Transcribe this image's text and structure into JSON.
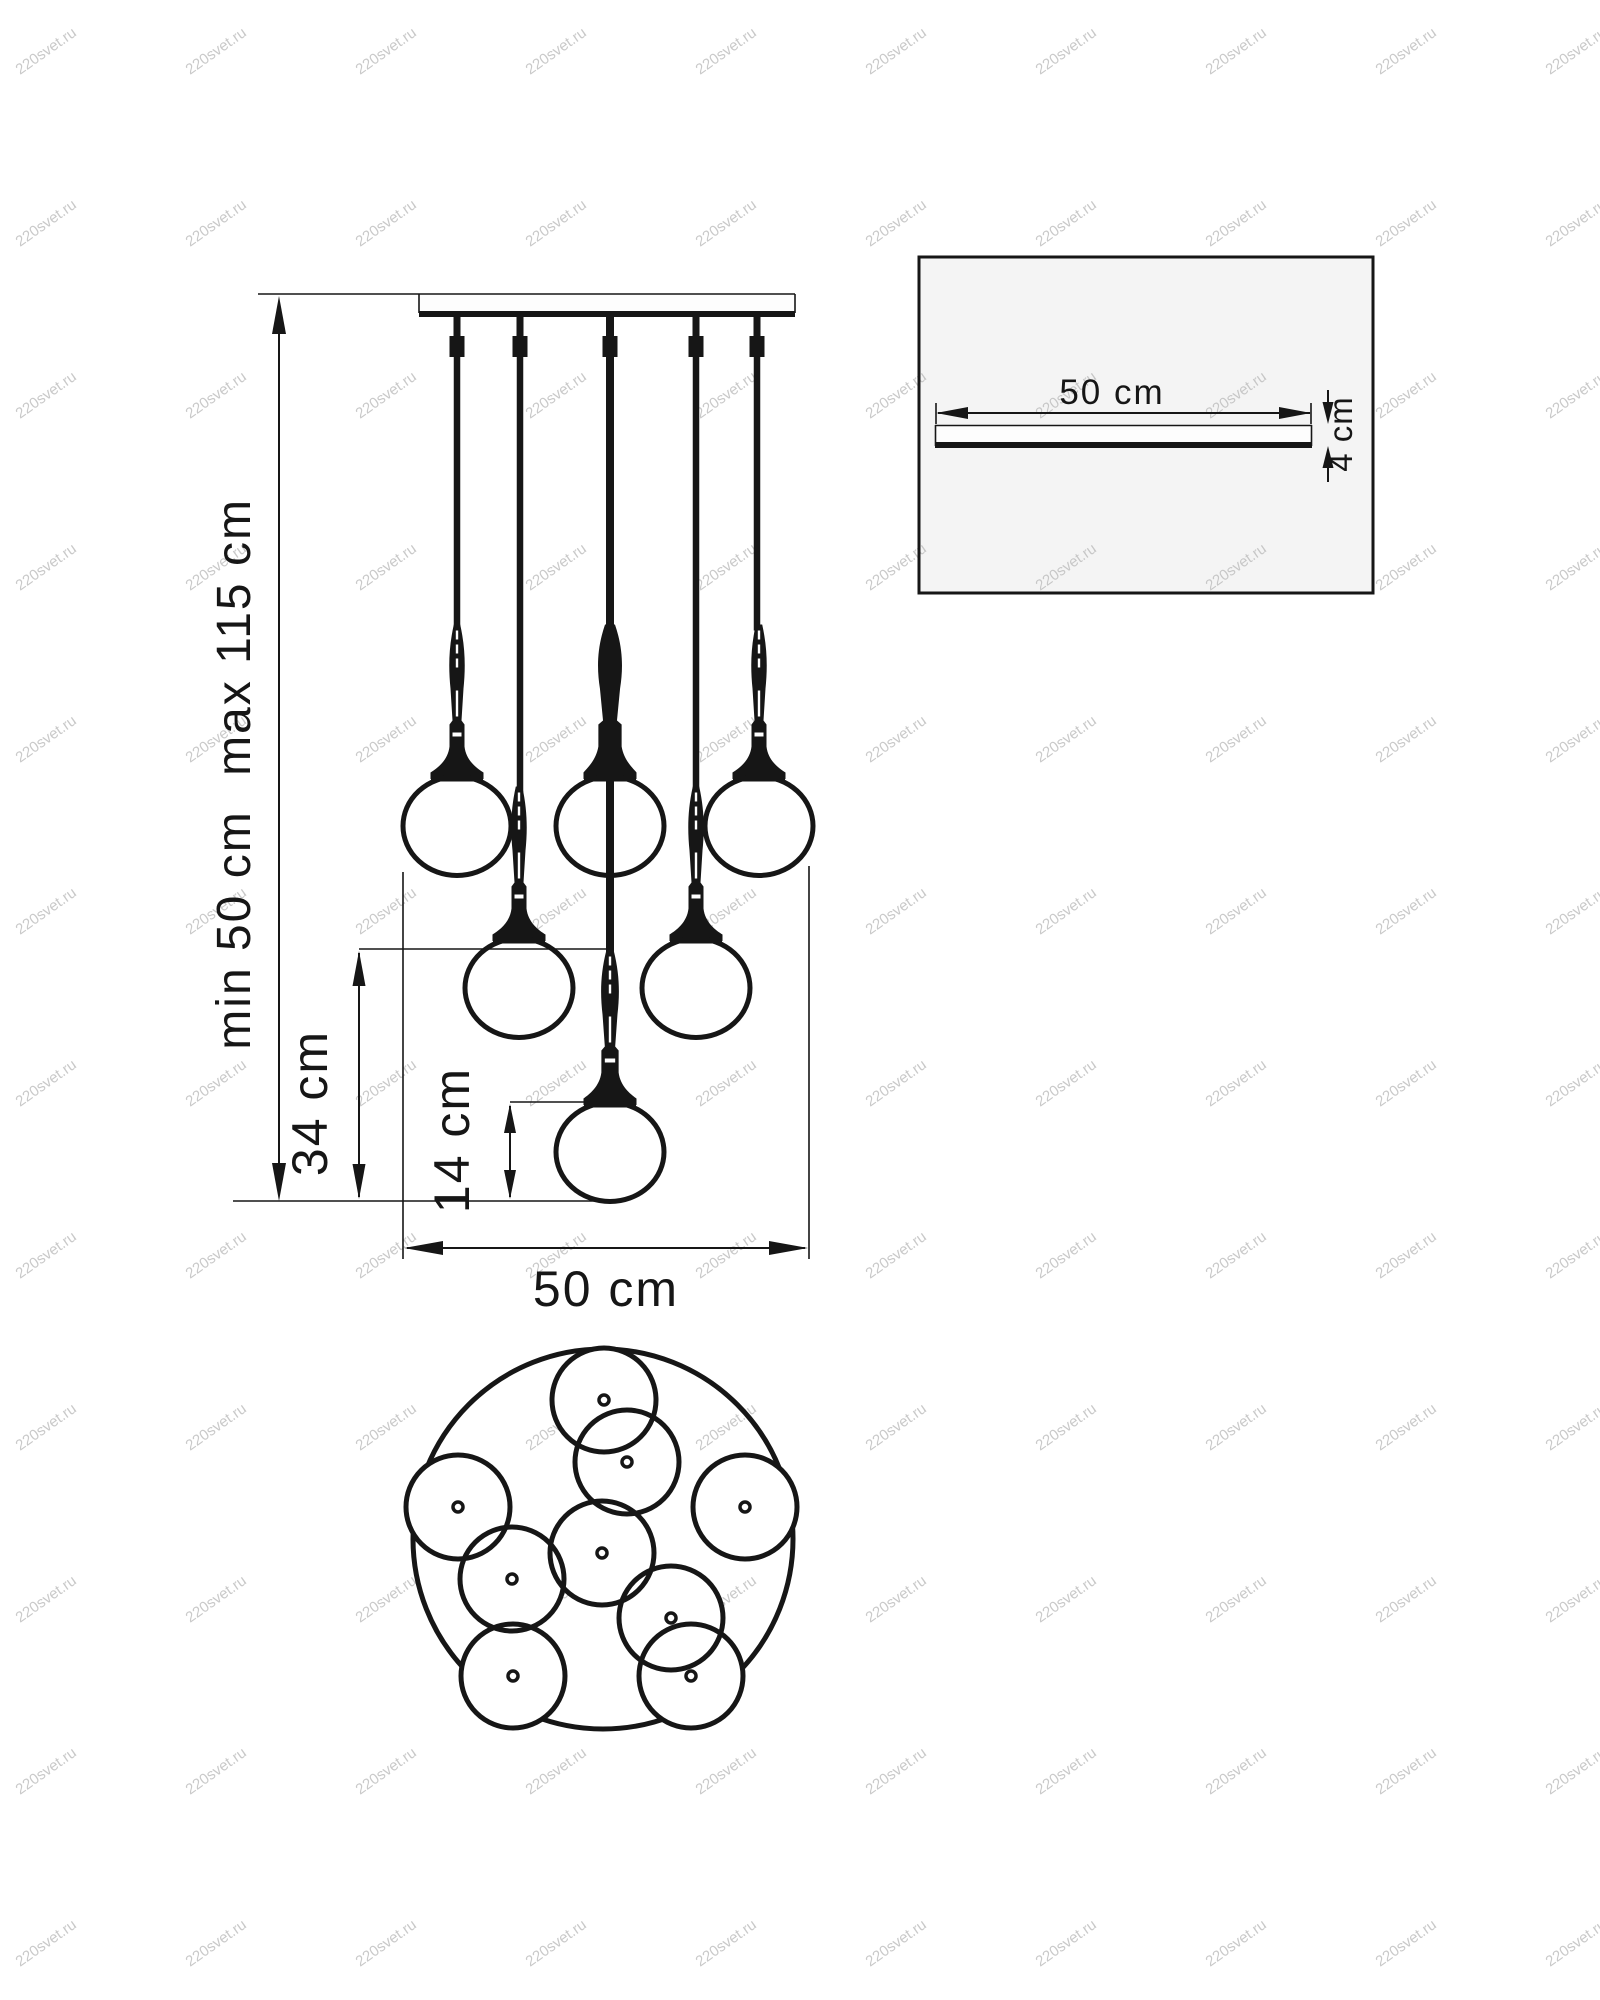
{
  "page": {
    "background": "#ffffff"
  },
  "colors": {
    "ink": "#161616",
    "detail_panel_bg": "#f4f4f4",
    "watermark": "#c0c0c0"
  },
  "watermark": {
    "text": "220svet.ru",
    "grid": {
      "cols": 10,
      "rows": 12,
      "x0": 20,
      "y0": 75,
      "dx": 170,
      "dy": 172,
      "angle": -35
    }
  },
  "front_view": {
    "labels": {
      "height_max": "max 115 cm",
      "height_min": "min 50 cm",
      "drop_34": "34 cm",
      "drop_14": "14 cm",
      "width": "50 cm"
    },
    "plate": {
      "x1": 419,
      "x2": 795,
      "y_top": 294,
      "y_bottom": 317,
      "ceiling_line_x1": 258
    },
    "cord_xs": [
      457,
      520,
      610,
      696,
      757
    ],
    "pendants": [
      {
        "cord_x": 457,
        "cx": 457,
        "cy": 826,
        "kind": "side"
      },
      {
        "cord_x": 520,
        "cx": 519,
        "cy": 988,
        "kind": "side"
      },
      {
        "cord_x": 610,
        "cx": 610,
        "cy": 826,
        "kind": "center-upper"
      },
      {
        "cord_x": 696,
        "cx": 696,
        "cy": 988,
        "kind": "side"
      },
      {
        "cord_x": 757,
        "cx": 759,
        "cy": 826,
        "kind": "side"
      },
      {
        "cord_x": 610,
        "cx": 610,
        "cy": 1152,
        "kind": "center-lower"
      }
    ],
    "globe_rx": 54,
    "globe_ry": 49.5
  },
  "detail_view": {
    "labels": {
      "width": "50 cm",
      "thickness": "4 cm"
    },
    "box": {
      "x": 919,
      "y": 257,
      "w": 454,
      "h": 336
    },
    "plate": {
      "x1": 935,
      "x2": 1312,
      "y1": 425,
      "y2": 447
    }
  },
  "top_view": {
    "center": [
      603,
      1539
    ],
    "radius": 190,
    "globe_radius": 52,
    "globes": [
      [
        604,
        1400
      ],
      [
        627,
        1462
      ],
      [
        458,
        1507
      ],
      [
        745,
        1507
      ],
      [
        602,
        1553
      ],
      [
        512,
        1579
      ],
      [
        671,
        1618
      ],
      [
        513,
        1676
      ],
      [
        691,
        1676
      ]
    ]
  }
}
